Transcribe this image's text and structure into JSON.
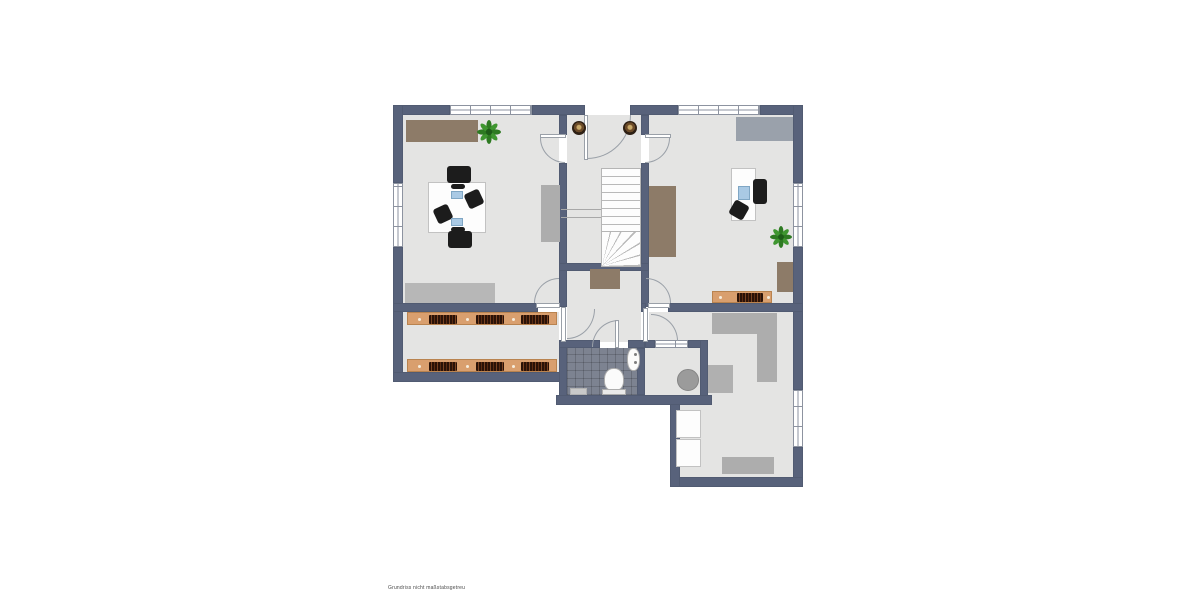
{
  "watermark": {
    "text": "Grundriss nicht maßstabsgetreu"
  },
  "colors": {
    "wall": "#58627b",
    "floor": "#e4e4e3",
    "background": "#ffffff",
    "tile": "#7d8391",
    "tile_line": "#6c7280",
    "wood": "#d99f6e",
    "books_dark": "#2a1207",
    "books_light": "#7a4322",
    "furniture_brown": "#8d7b68",
    "furniture_gray": "#adadad",
    "furniture_light_gray": "#b7b7b7",
    "furniture_white": "#fdfdfd",
    "plant_green": "#2e7a22",
    "window_frame": "#8d93a0",
    "door_line": "#9aa0a8",
    "stair_tread_line": "#b9b9b9",
    "lamp_brown": "#5d4426",
    "screen_blue": "#a9c9e4",
    "chair_black": "#1c1c1c",
    "basket_gray": "#9b9b9b"
  },
  "floorplan": {
    "type": "floor-plan",
    "rooms": [
      {
        "name": "office-left",
        "furniture": [
          "brown sideboard",
          "potted plant",
          "meeting table with 2 laptops",
          "4 black chairs",
          "gray cabinet",
          "gray rug"
        ]
      },
      {
        "name": "entrance-hall-with-stairs",
        "furniture": [
          "entrance door",
          "2 round lamps",
          "staircase with winder",
          "brown doormat"
        ]
      },
      {
        "name": "office-right",
        "furniture": [
          "gray sideboard",
          "desk with monitor",
          "office chair",
          "potted plant",
          "brown sideboard at stair wall",
          "brown wall cabinet",
          "small bookshelf"
        ]
      },
      {
        "name": "library-room",
        "furniture": [
          "long bookshelf top",
          "long bookshelf bottom"
        ]
      },
      {
        "name": "bathroom",
        "furniture": [
          "toilet",
          "wash basin",
          "bath mat"
        ],
        "floor": "dark tiles"
      },
      {
        "name": "storage-room",
        "furniture": [
          "round laundry basket"
        ],
        "window": true
      },
      {
        "name": "room-bottom-right",
        "furniture": [
          "gray L wardrobe",
          "gray cabinet",
          "2 white cabinets",
          "gray lowboard"
        ]
      }
    ],
    "windows": 6,
    "doors": 8
  }
}
